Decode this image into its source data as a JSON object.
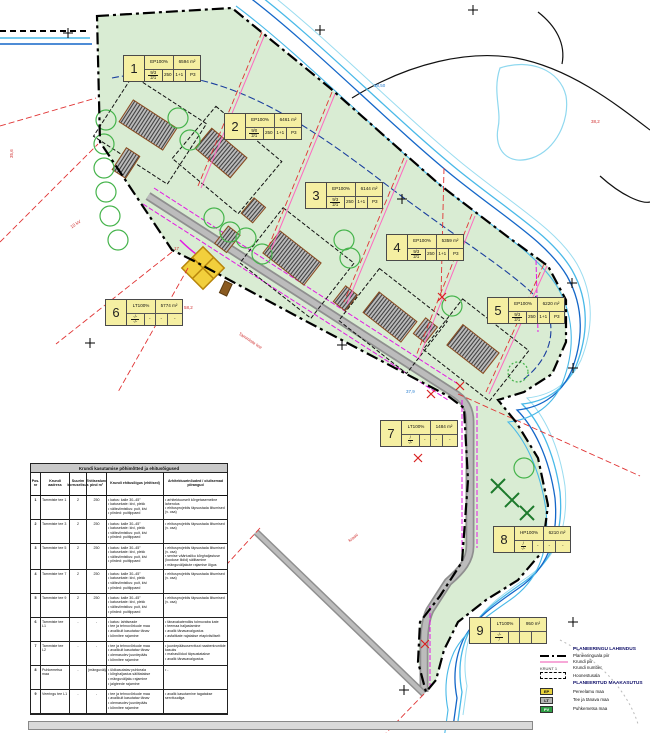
{
  "plots": [
    {
      "num": "1",
      "code": "EP100%",
      "area": "6594 m²",
      "frac_top": "9/3",
      "frac_bot": "2/1",
      "c2": "250",
      "c3": "1+1",
      "c4": "P3",
      "x": 123,
      "y": 55
    },
    {
      "num": "2",
      "code": "EP100%",
      "area": "6461 m²",
      "frac_top": "9/0",
      "frac_bot": "2/1",
      "c2": "250",
      "c3": "1+1",
      "c4": "P3",
      "x": 224,
      "y": 113
    },
    {
      "num": "3",
      "code": "EP100%",
      "area": "6144 m²",
      "frac_top": "9/3",
      "frac_bot": "2/1",
      "c2": "250",
      "c3": "1+1",
      "c4": "P3",
      "x": 305,
      "y": 182
    },
    {
      "num": "4",
      "code": "EP100%",
      "area": "5359 m²",
      "frac_top": "9/3",
      "frac_bot": "2/1",
      "c2": "250",
      "c3": "1+1",
      "c4": "P3",
      "x": 386,
      "y": 234
    },
    {
      "num": "5",
      "code": "EP100%",
      "area": "6220 m²",
      "frac_top": "9/3",
      "frac_bot": "2/1",
      "c2": "250",
      "c3": "1+1",
      "c4": "P3",
      "x": 487,
      "y": 297
    },
    {
      "num": "6",
      "code": "LT100%",
      "area": "5774 m²",
      "frac_top": "-/-",
      "frac_bot": "-/-",
      "c2": "-",
      "c3": "-",
      "c4": "-",
      "x": 105,
      "y": 299
    },
    {
      "num": "7",
      "code": "LT100%",
      "area": "1484 m²",
      "frac_top": "/",
      "frac_bot": "-/-",
      "c2": "-",
      "c3": "-",
      "c4": "-",
      "x": 380,
      "y": 420
    },
    {
      "num": "8",
      "code": "HP100%",
      "area": "6210 m²",
      "frac_top": "/",
      "frac_bot": "-/-",
      "c2": "-",
      "c3": "-",
      "c4": "-",
      "x": 493,
      "y": 526
    },
    {
      "num": "9",
      "code": "LT100%",
      "area": "950 m²",
      "frac_top": "-/-",
      "frac_bot": "/",
      "c2": "",
      "c3": "",
      "c4": "",
      "x": 469,
      "y": 617
    }
  ],
  "table": {
    "title": "Krundi kasutamise põhimõtted ja ehitusõigused",
    "headers": [
      "Pos. nr",
      "Krundi aadress",
      "Suurim korruselisus",
      "Ehitisealune pind m²",
      "Krundi ehitusõigus (ehitised)",
      "Arhitektuurinõuded / olulisemad piirangud"
    ],
    "rows": [
      {
        "nr": "1",
        "name": "Tammiste tee 1",
        "floors": "2",
        "area": "250",
        "rights": [
          "katus: kalle 30–45°",
          "katusekate: kivi, plekk",
          "välisviimistlus: puit, kivi",
          "piirded: puitlippaed"
        ],
        "notes": [
          "arhitektuurselt kõrgetasemeline lahendus",
          "ehitusprojektis täpsustada liitumised (v. osa)"
        ]
      },
      {
        "nr": "2",
        "name": "Tammiste tee 3",
        "floors": "2",
        "area": "250",
        "rights": [
          "katus: kalle 30–45°",
          "katusekate: kivi, plekk",
          "välisviimistlus: puit, kivi",
          "piirded: puitlippaed"
        ],
        "notes": [
          "ehitusprojektis täpsustada liitumised (v. osa)"
        ]
      },
      {
        "nr": "3",
        "name": "Tammiste tee 5",
        "floors": "2",
        "area": "250",
        "rights": [
          "katus: kalle 30–45°",
          "katusekate: kivi, plekk",
          "välisviimistlus: puit, kivi",
          "piirded: puitlippaed"
        ],
        "notes": [
          "ehitusprojektis täpsustada liitumised (v. osa)",
          "senise väärtusliku kõrghaljastuse (looduse liidid) säilitamine",
          "mänguväljakute rajamise õigus"
        ]
      },
      {
        "nr": "4",
        "name": "Tammiste tee 7",
        "floors": "2",
        "area": "250",
        "rights": [
          "katus: kalle 30–45°",
          "katusekate: kivi, plekk",
          "välisviimistlus: puit, kivi",
          "piirded: puitlippaed"
        ],
        "notes": [
          "ehitusprojektis täpsustada liitumised (v. osa)"
        ]
      },
      {
        "nr": "5",
        "name": "Tammiste tee 9",
        "floors": "2",
        "area": "250",
        "rights": [
          "katus: kalle 30–45°",
          "katusekate: kivi, plekk",
          "välisviimistlus: puit, kivi",
          "piirded: puitlippaed"
        ],
        "notes": [
          "ehitusprojektis täpsustada liitumised (v. osa)"
        ]
      },
      {
        "nr": "6",
        "name": "Tammiste tee L1",
        "floors": "-",
        "area": "-",
        "rights": [
          "katus: lahtiseade",
          "tee ja tehnovõrkude maa",
          "avalikult kasutatav tänav",
          "kõnnitee rajamine"
        ],
        "notes": [
          "tänavakatendiks tolmuvaba kate",
          "teemaa haljastamine",
          "avalik tänavavalgustus",
          "asfaltkate rajatakse etapiviisiliselt"
        ]
      },
      {
        "nr": "7",
        "name": "Tammiste tee L2",
        "floors": "-",
        "area": "-",
        "rights": [
          "tee ja tehnovõrkude maa",
          "avalikult kasutatav tänav",
          "olemasolev juurdepääs",
          "kõnnitee rajamine"
        ],
        "notes": [
          "juurdepääsuservituut naaberkruntide kasuks",
          "mahasõidud täpsustatakse",
          "avalik tänavavalgustus"
        ]
      },
      {
        "nr": "8",
        "name": "Puhkemetsa maa",
        "floors": "-",
        "area": "(mänguväljak)",
        "rights": [
          "üldkasutatav puhkeala",
          "kõrghaljastus säilitatakse",
          "mänguväljaku rajamine",
          "jalgteede rajamine"
        ],
        "notes": [
          "-"
        ]
      },
      {
        "nr": "9",
        "name": "Veeringu tee L1",
        "floors": "-",
        "area": "-",
        "rights": [
          "tee ja tehnovõrkude maa",
          "avalikult kasutatav tänav",
          "olemasolev juurdepääs",
          "kõnnitee rajamine"
        ],
        "notes": [
          "avalik kasutamine tagatakse servituudiga"
        ]
      }
    ]
  },
  "legend": {
    "solution_title": "PLANEERINGU LAHENDUS",
    "items": [
      {
        "symbol": "dashdot",
        "label": "Planeeringuala piir"
      },
      {
        "symbol": "pink",
        "label": "Krundi piir"
      },
      {
        "symbol": "krunt",
        "symbol_text": "KRUNT 1",
        "label": "Krundi number"
      },
      {
        "symbol": "dashedrect",
        "label": "Hoonestusala"
      }
    ],
    "landuse_title": "PLANEERITUD MAAKASUTUS",
    "landuse": [
      {
        "code": "EP",
        "color": "#e8d23e",
        "label": "Pereelamu maa"
      },
      {
        "code": "LT",
        "color": "#b5b5b5",
        "label": "Tee ja tänava maa"
      },
      {
        "code": "PV",
        "color": "#2f9e45",
        "label": "Puhkemetsa maa"
      }
    ]
  },
  "annotations": [
    {
      "text": "38,2",
      "x": 591,
      "y": 120,
      "color": "#d03030",
      "rot": 0
    },
    {
      "text": "35,6",
      "x": 10,
      "y": 158,
      "color": "#d03030",
      "rot": -90
    },
    {
      "text": "17",
      "x": 174,
      "y": 247,
      "color": "#d03030",
      "rot": 0
    },
    {
      "text": "Tammiste tee",
      "x": 240,
      "y": 332,
      "color": "#d03030",
      "rot": 33
    },
    {
      "text": "10 kV",
      "x": 70,
      "y": 226,
      "color": "#d03030",
      "rot": -33
    },
    {
      "text": "58,2",
      "x": 184,
      "y": 306,
      "color": "#d03030",
      "rot": 0
    },
    {
      "text": "38,50",
      "x": 374,
      "y": 84,
      "color": "#2a7fd0",
      "rot": 0
    },
    {
      "text": "37,9",
      "x": 406,
      "y": 390,
      "color": "#2a7fd0",
      "rot": 0
    },
    {
      "text": "kraav",
      "x": 348,
      "y": 540,
      "color": "#d03030",
      "rot": -40
    }
  ],
  "colors": {
    "area_green": "#d9ecd3",
    "label_yellow": "#f5efa2",
    "road_gray": "#8f8f8f",
    "stream_blue": "#49b9e8",
    "stream_dark": "#1467c8",
    "boundary_black": "#000000",
    "plot_pink": "#ff69c0",
    "red_line": "#e03434",
    "magenta_utility": "#e318e3"
  }
}
